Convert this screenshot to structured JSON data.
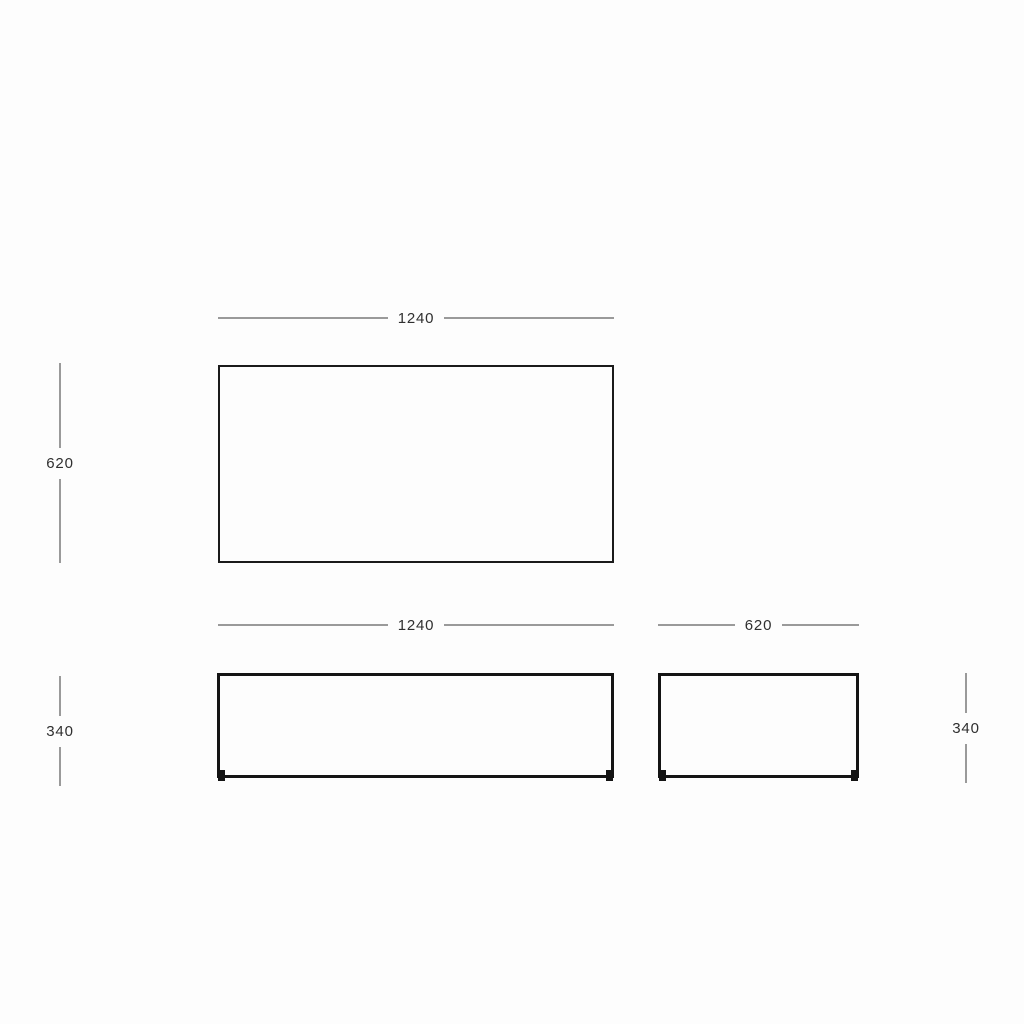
{
  "diagram": {
    "type": "furniture-dimension-drawing",
    "views": {
      "top": {
        "name": "top-view",
        "width": "1240",
        "depth": "620"
      },
      "front": {
        "name": "front-view",
        "width": "1240",
        "height": "340"
      },
      "side": {
        "name": "side-view",
        "width": "620",
        "height": "340"
      }
    },
    "dims": {
      "top_width": "1240",
      "top_depth": "620",
      "front_width": "1240",
      "front_height": "340",
      "side_width": "620",
      "side_height": "340"
    },
    "colors": {
      "background": "#fdfdfd",
      "outline": "#1b1b1b",
      "outline_heavy": "#141414",
      "dim_line": "#9a9a9a",
      "dim_text": "#2f2f2f"
    }
  }
}
